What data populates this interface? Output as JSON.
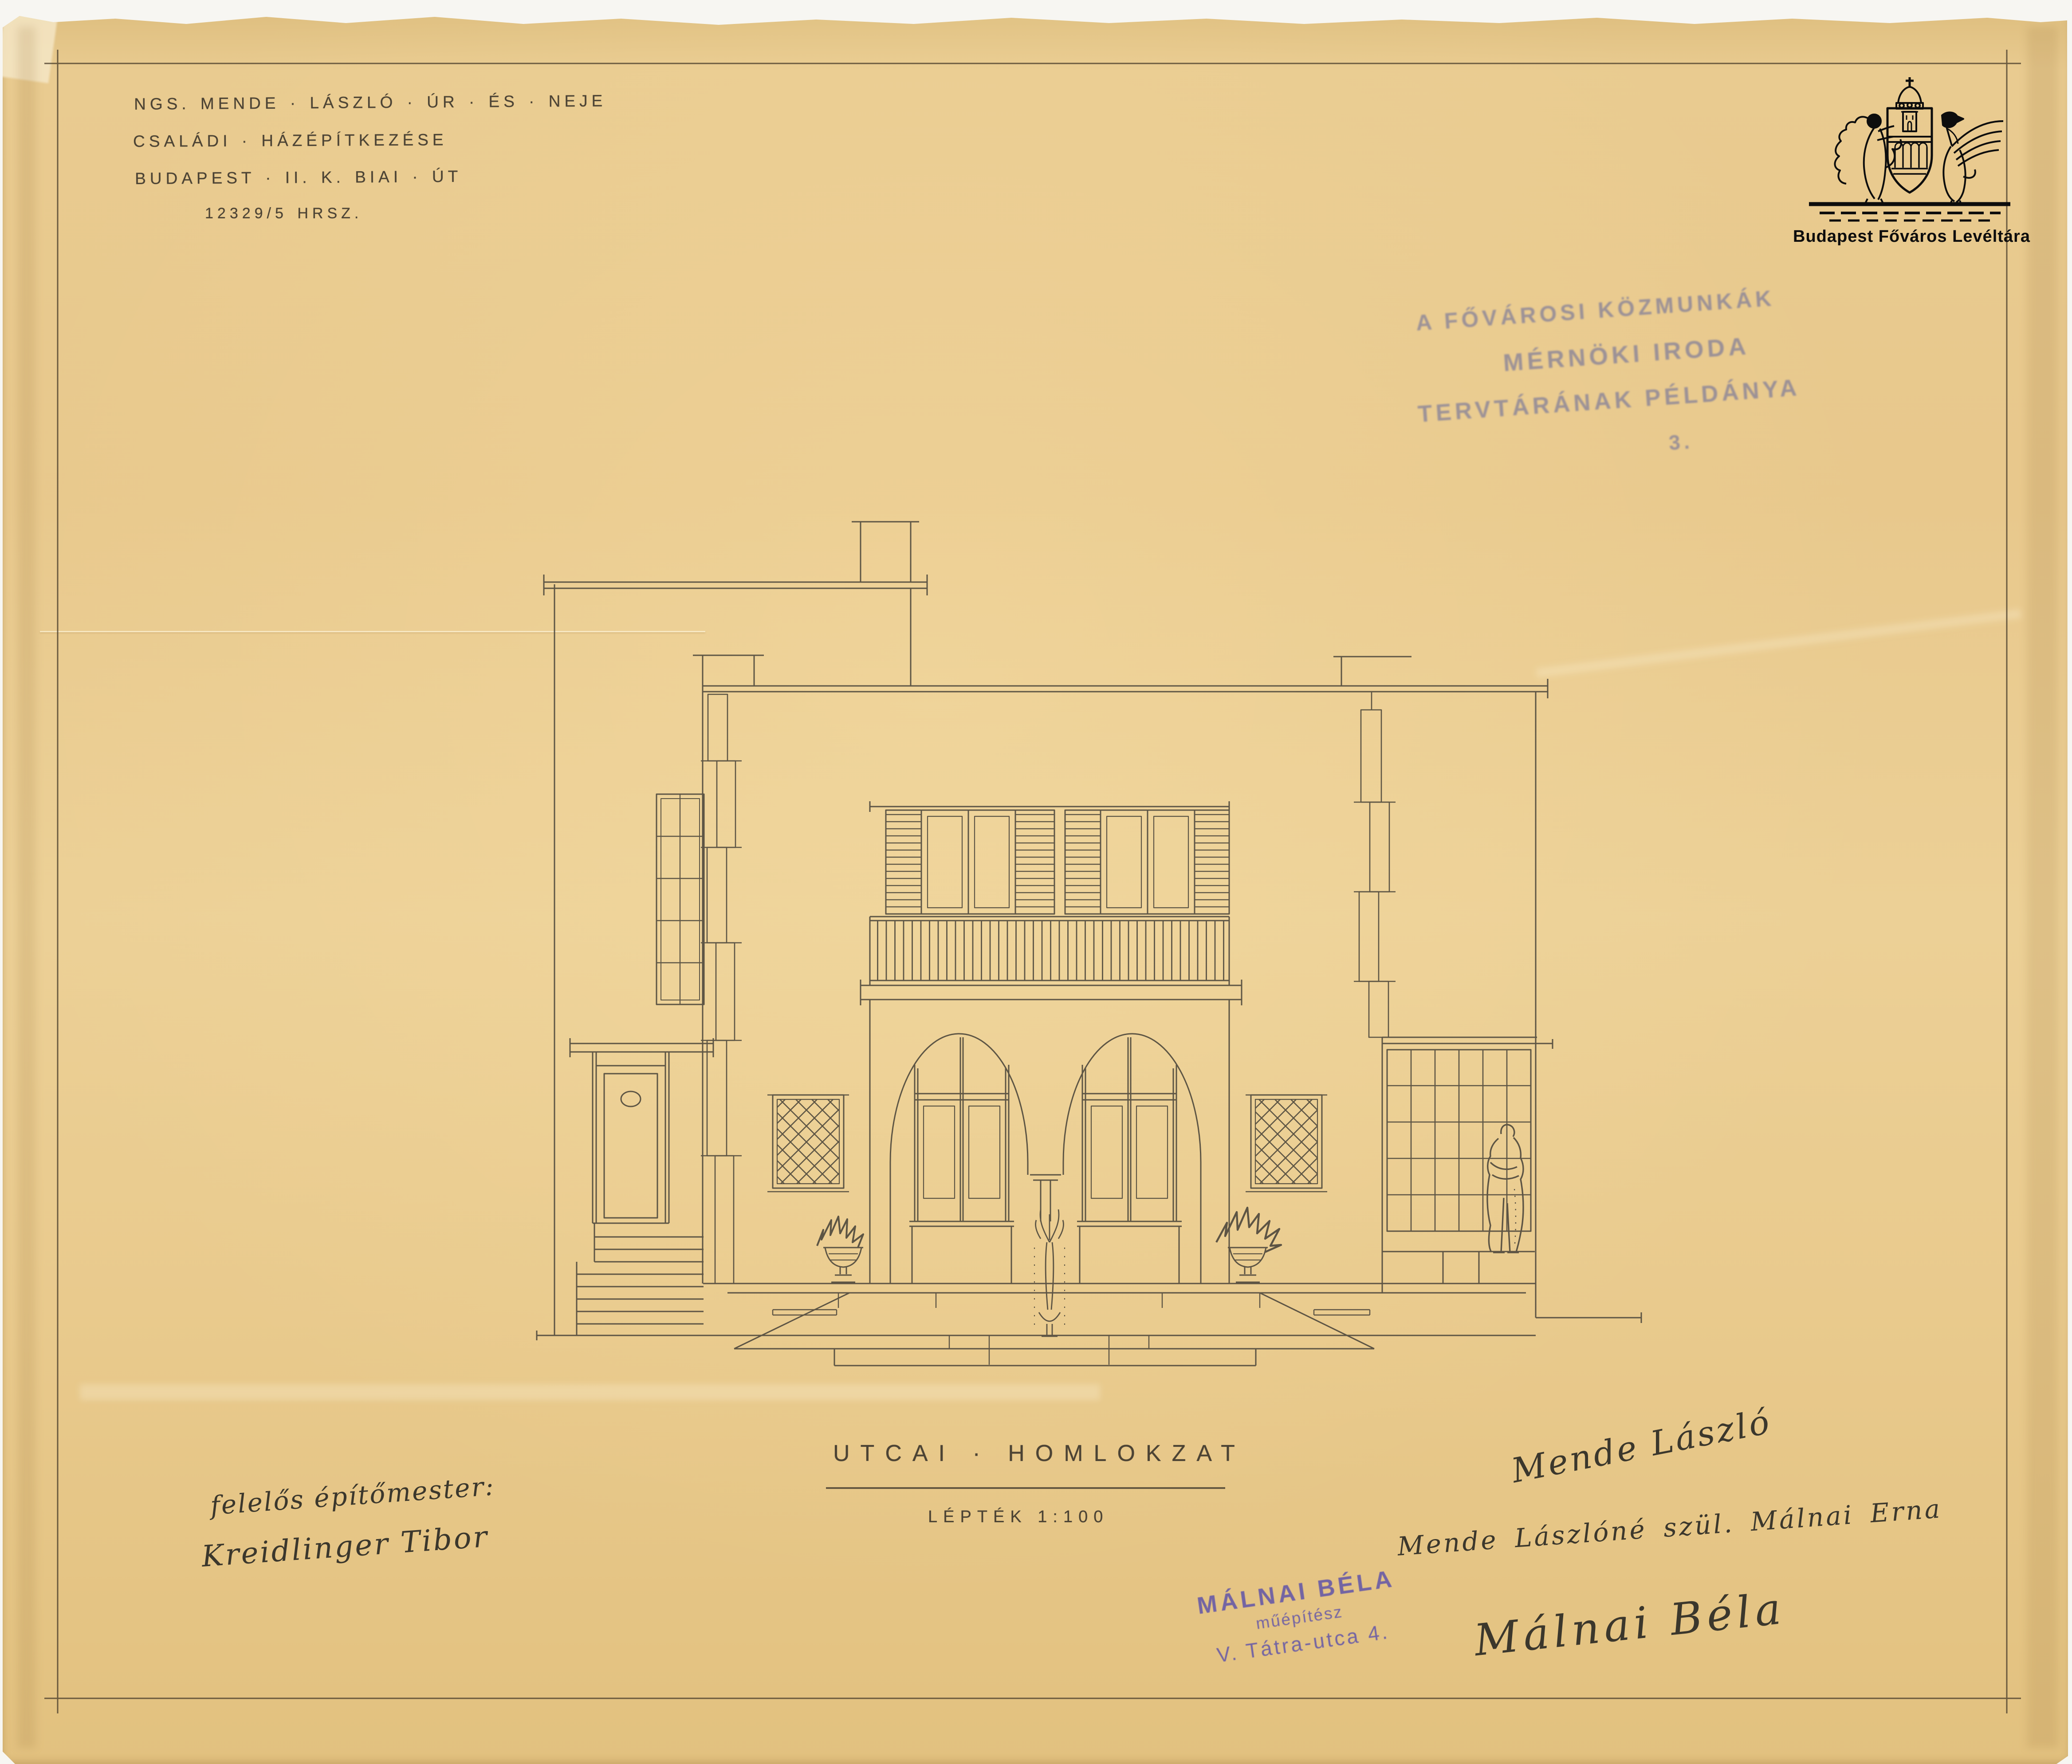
{
  "header": {
    "project_lines": [
      "NGS. MENDE · LÁSZLÓ · ÚR · ÉS · NEJE",
      "CSALÁDI · HÁZÉPÍTKEZÉSE",
      "BUDAPEST · II. K. BIAI · ÚT",
      "12329/5 HRSZ."
    ]
  },
  "archive_logo": {
    "caption": "Budapest Főváros Levéltára"
  },
  "archive_stamp": {
    "line1": "A FŐVÁROSI KÖZMUNKÁK",
    "line2": "MÉRNÖKI IRODA",
    "line3": "TERVTÁRÁNAK PÉLDÁNYA",
    "number": "3."
  },
  "drawing": {
    "title": "UTCAI · HOMLOKZAT",
    "scale_label": "LÉPTÉK 1:100"
  },
  "architect_stamp": {
    "name": "MÁLNAI BÉLA",
    "role": "műépítész",
    "address": "V. Tátra-utca 4."
  },
  "signatures": {
    "master_builder_label": "felelős építőmester:",
    "master_builder": "Kreidlinger Tibor",
    "owner": "Mende László",
    "owner_wife": "Mende Lászlóné szül. Málnai Erna",
    "architect": "Málnai Béla"
  },
  "colors": {
    "paper": "#e9c98e",
    "ink": "#4e483c",
    "stamp_purple": "#6a5ca6",
    "stamp_faded": "#5d639c",
    "logo_black": "#0d0d0d"
  }
}
